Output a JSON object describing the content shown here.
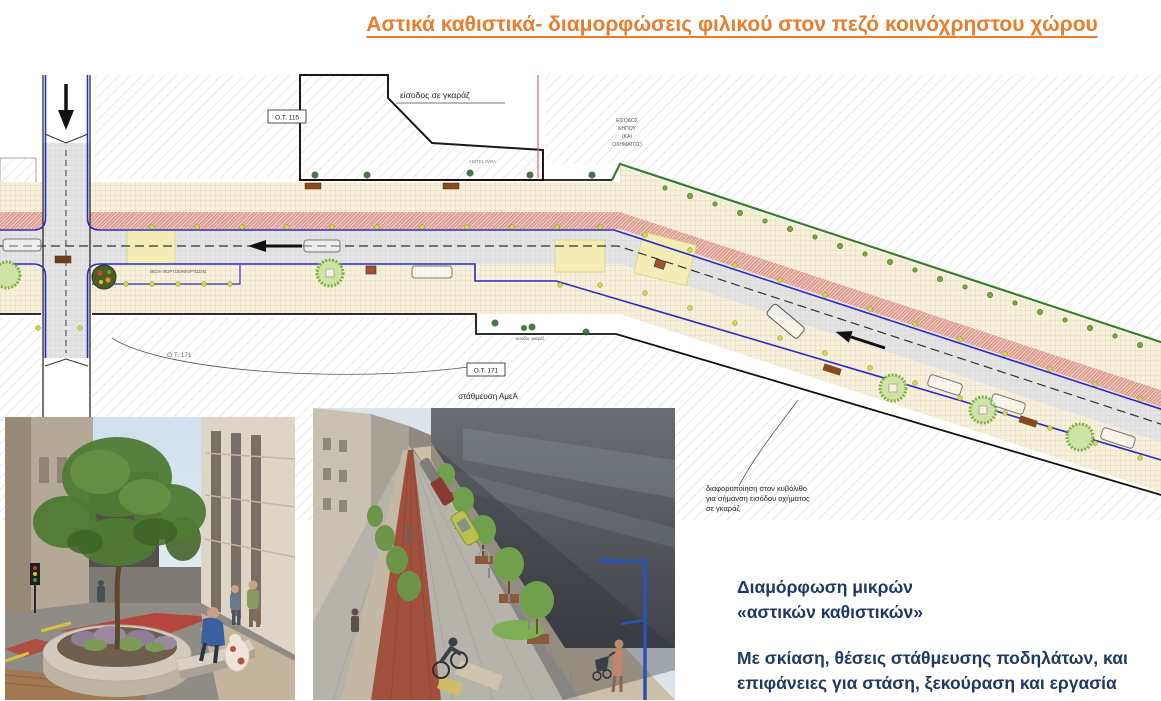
{
  "title": {
    "text": "Αστικά καθιστικά- διαμορφώσεις φιλικού στον πεζό κοινόχρηστου χώρου",
    "color": "#E87D2E"
  },
  "plan": {
    "labels": {
      "garage_entrance_top": "είσοδος σε γκαράζ",
      "block_ot115": "Ο.Τ. 115",
      "garden_entrance_lines": [
        "ΕΙΣΟΔΟΣ",
        "ΚΗΠΟΥ",
        "(ΚΑΙ",
        "ΟΧΗΜΑΤΟΣ)"
      ],
      "hotel": "HOTEL AVRA",
      "loading_zone": "ΘΕΣΗ ΦΟΡΤΟΕΚΦΟΡΤΩΣΗΣ",
      "block_ot171_plain": "Ο.Τ. 171",
      "block_ot171_boxed": "Ο.Τ. 171",
      "disabled_parking": "στάθμευση ΑμεΑ",
      "garage_entrance_small": "είσοδος γκαράζ",
      "cobble_note_lines": [
        "διαφοροποίηση στον κυβόλιθο",
        "για σήμανση εισόδου οχήματος",
        "σε γκαράζ"
      ]
    },
    "colors": {
      "bike_lane": "#C0574A",
      "sidewalk": "#F6F0DC",
      "road": "#E4E4E4",
      "curb_line": "#2B2BC4",
      "bollard": "#CDD94A",
      "tree": "#7FB241",
      "bench": "#8A4A1F"
    }
  },
  "captions": {
    "heading_line1": "Διαμόρφωση μικρών",
    "heading_line2": "«αστικών καθιστικών»",
    "body_line1": "Με σκίαση, θέσεις στάθμευσης ποδηλάτων, και",
    "body_line2": "επιφάνειες για στάση, ξεκούραση και εργασία",
    "color": "#1F3864"
  }
}
